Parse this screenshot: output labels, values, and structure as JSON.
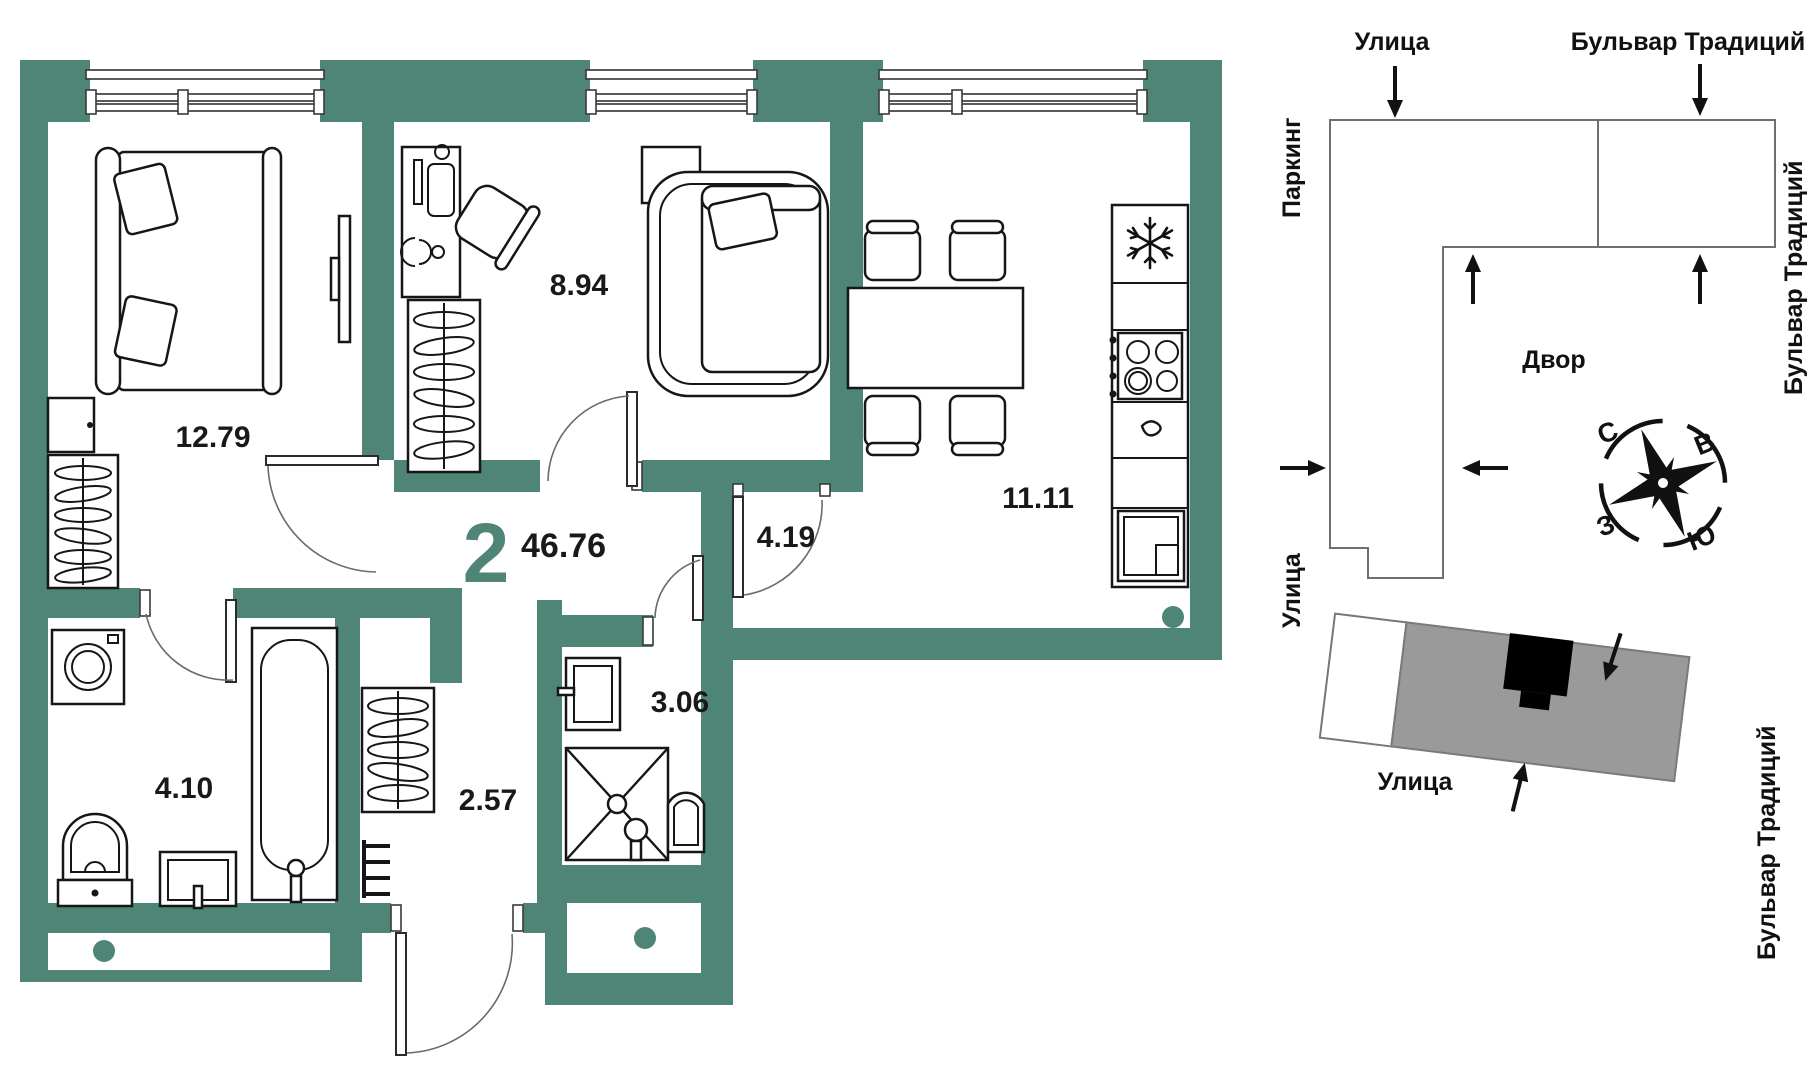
{
  "colors": {
    "wall_teal": "#4f8577",
    "line_dark": "#161616",
    "building_gray": "#9a9a9a",
    "site_outline": "#6f6f6f"
  },
  "plan": {
    "number": "2",
    "total_area": "46.76",
    "areas": {
      "bedroom": "12.79",
      "office": "8.94",
      "kitchen": "11.11",
      "hall": "4.19",
      "shower": "3.06",
      "entry": "2.57",
      "bathroom": "4.10"
    }
  },
  "site": {
    "street_top": "Улица",
    "boulevard_top": "Бульвар Традиций",
    "boulevard_right": "Бульвар Традиций",
    "boulevard_right_lower": "Бульвар Традиций",
    "parking": "Паркинг",
    "street_left": "Улица",
    "yard": "Двор",
    "street_bottom": "Улица",
    "compass": {
      "n": "С",
      "e": "В",
      "s": "Ю",
      "w": "З"
    }
  }
}
